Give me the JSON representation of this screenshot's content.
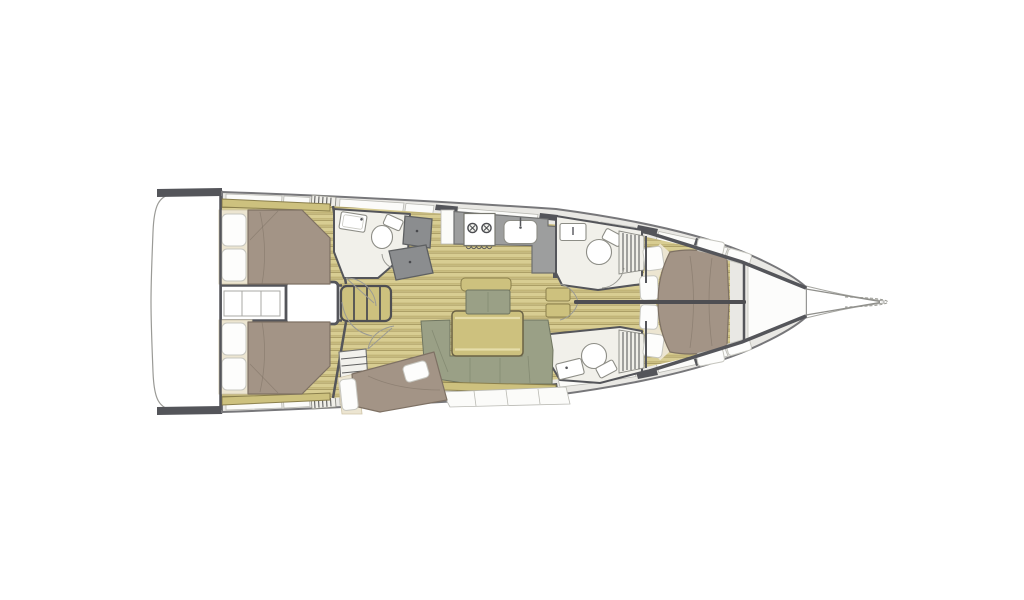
{
  "page": {
    "type": "yacht-interior-floor-plan",
    "background": "#ffffff"
  },
  "colors": {
    "hull-outline": "#85858a",
    "wall": "#54555a",
    "deck": "#e9e8e4",
    "panel": "#fbfbf9",
    "panel-stroke": "#b9b9b3",
    "wood-base": "#d8cd92",
    "wood-stripe": "#c2b578",
    "wood-dark": "#a2945c",
    "khaki": "#cdc17e",
    "khaki-stroke": "#8a7f4c",
    "olive": "#9aa086",
    "olive-stroke": "#6f7560",
    "bed": "#a39486",
    "bed-stroke": "#7e7164",
    "cream": "#ece5d1",
    "cream-stroke": "#cfc5a9",
    "pillow": "#fdfdfc",
    "pillow-stroke": "#c6c6bf",
    "counter": "#9d9e9e",
    "counter-stroke": "#6e6f6f",
    "navdesk": "#8b8d8f",
    "navdesk-stroke": "#5e6062",
    "headfloor": "#f1f0ea",
    "fixture": "#ffffff",
    "fixture-stroke": "#8d8d86",
    "line": "#9a9a94",
    "white": "#ffffff"
  },
  "rooms": {
    "plan": "Sailboat interior layout plan, bow to the right",
    "transom": "Swim platform / transom",
    "aft_cabin_port": "Aft cabin (port) with double berth",
    "aft_cabin_starboard": "Aft cabin (starboard) with double berth",
    "engine_box": "Companionway / engine box",
    "steps": "Companionway steps",
    "shelves": "Storage shelves",
    "day_head": "Day head with shower and washbasin",
    "nav": "Chart table / nav station",
    "galley": "Galley",
    "stove": "Two-burner stove",
    "galley_sink": "Galley sink",
    "port_head": "Port forward head with toilet",
    "stbd_head": "Starboard forward head with toilet",
    "skipper_cabin": "Skipper berth (aft center)",
    "saloon_settee": "U-shaped saloon settee",
    "saloon_table": "Saloon table",
    "armchair": "Saloon armchair",
    "owner_cabin": "Owner cabin (bow) with island berth",
    "bow_locker": "Anchor locker",
    "bowsprit": "Bowsprit"
  }
}
